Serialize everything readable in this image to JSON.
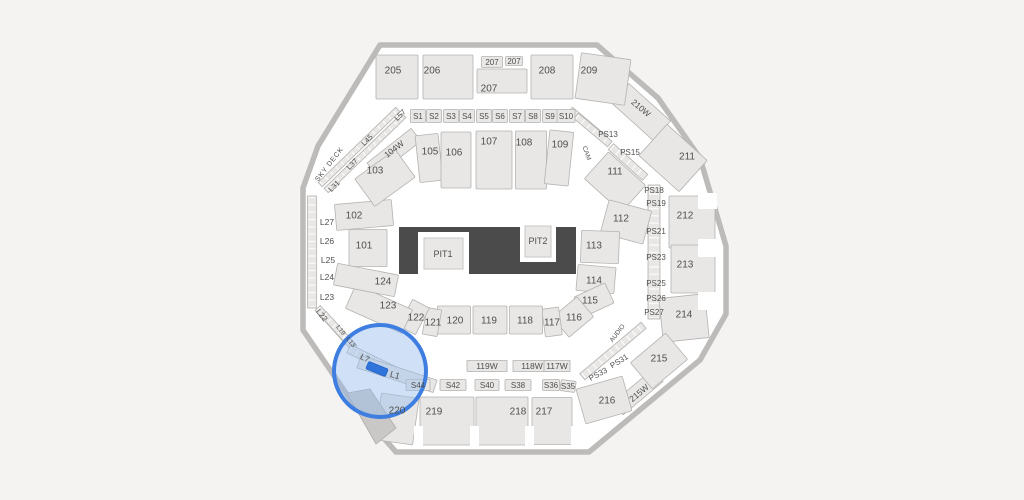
{
  "app": {
    "view": "arena-seating-map"
  },
  "colors": {
    "background": "#f4f3f1",
    "floor": "#ffffff",
    "wall": "#bdbbb9",
    "section_fill": "#e8e7e6",
    "section_stroke": "#b5b3b1",
    "label": "#4f4f4f",
    "label_light": "#9b9b9b",
    "stage_fill": "#4b4b4b",
    "highlight_fill": "rgba(151,188,238,0.45)",
    "highlight_ring": "#3e7ee0",
    "selected_fill": "#2e74da"
  },
  "stage": {
    "label": "STAGE",
    "pit1": "PIT1",
    "pit2": "PIT2"
  },
  "highlight": {
    "circle": {
      "cx": 380,
      "cy": 371,
      "r": 46
    },
    "selected": {
      "cx": 377,
      "cy": 369,
      "w": 21,
      "h": 8,
      "rot": 22
    }
  },
  "sections": [
    [
      "205",
      397,
      77,
      42,
      44,
      0,
      393,
      70
    ],
    [
      "206",
      448,
      77,
      50,
      44,
      0,
      432,
      70
    ],
    [
      "207",
      492,
      62,
      21,
      11,
      0,
      492,
      62,
      8
    ],
    [
      "207",
      514,
      61,
      17,
      9,
      0,
      514,
      61,
      8
    ],
    [
      "207",
      502,
      81,
      50,
      24,
      0,
      489,
      88
    ],
    [
      "208",
      552,
      77,
      42,
      44,
      0,
      547,
      70
    ],
    [
      "209",
      603,
      79,
      50,
      46,
      8,
      589,
      70
    ],
    [
      "211",
      673,
      158,
      54,
      42,
      42,
      687,
      156
    ],
    [
      "212",
      692,
      222,
      46,
      52,
      0,
      685,
      215
    ],
    [
      "213",
      693,
      269,
      44,
      48,
      0,
      685,
      264
    ],
    [
      "214",
      684,
      318,
      46,
      44,
      -6,
      684,
      314
    ],
    [
      "215",
      659,
      361,
      46,
      34,
      -40,
      659,
      358
    ],
    [
      "216",
      604,
      400,
      48,
      36,
      -16,
      607,
      400
    ],
    [
      "217",
      552,
      421,
      40,
      47,
      0,
      544,
      411
    ],
    [
      "218",
      502,
      421,
      52,
      48,
      0,
      518,
      411
    ],
    [
      "219",
      447,
      421,
      54,
      48,
      0,
      434,
      411
    ],
    [
      "220",
      397,
      419,
      38,
      47,
      8,
      397,
      410
    ],
    [
      "S44",
      418,
      385,
      24,
      11,
      0,
      418,
      385,
      8
    ],
    [
      "S42",
      453,
      385,
      26,
      11,
      0,
      453,
      385,
      8
    ],
    [
      "S40",
      487,
      385,
      24,
      11,
      0,
      487,
      385,
      8
    ],
    [
      "S38",
      518,
      385,
      26,
      11,
      0,
      518,
      385,
      8
    ],
    [
      "S36",
      551,
      385,
      17,
      11,
      0,
      551,
      385,
      8
    ],
    [
      "S35",
      568,
      386,
      15,
      11,
      8,
      568,
      386,
      8
    ],
    [
      "S1",
      418,
      116,
      15,
      13,
      0,
      418,
      116,
      8
    ],
    [
      "S2",
      434,
      116,
      15,
      13,
      0,
      434,
      116,
      8
    ],
    [
      "S3",
      451,
      116,
      15,
      13,
      0,
      451,
      116,
      8
    ],
    [
      "S4",
      467,
      116,
      15,
      13,
      0,
      467,
      116,
      8
    ],
    [
      "S5",
      484,
      116,
      15,
      13,
      0,
      484,
      116,
      8
    ],
    [
      "S6",
      500,
      116,
      15,
      13,
      0,
      500,
      116,
      8
    ],
    [
      "S7",
      517,
      116,
      15,
      13,
      0,
      517,
      116,
      8
    ],
    [
      "S8",
      533,
      116,
      15,
      13,
      0,
      533,
      116,
      8
    ],
    [
      "S9",
      550,
      116,
      15,
      13,
      0,
      550,
      116,
      8
    ],
    [
      "S10",
      566,
      116,
      18,
      13,
      0,
      566,
      116,
      8
    ],
    [
      "101",
      368,
      248,
      38,
      37,
      0,
      364,
      245
    ],
    [
      "102",
      364,
      215,
      57,
      26,
      -5,
      354,
      215
    ],
    [
      "103",
      385,
      178,
      50,
      34,
      -36,
      375,
      170
    ],
    [
      "105",
      429,
      158,
      23,
      47,
      -6,
      430,
      151
    ],
    [
      "106",
      456,
      160,
      30,
      56,
      0,
      454,
      152
    ],
    [
      "107",
      494,
      160,
      36,
      58,
      0,
      489,
      141
    ],
    [
      "108",
      531,
      160,
      31,
      58,
      0,
      524,
      142
    ],
    [
      "109",
      559,
      158,
      24,
      54,
      6,
      560,
      144
    ],
    [
      "111",
      615,
      182,
      50,
      36,
      42,
      615,
      171
    ],
    [
      "112",
      626,
      222,
      44,
      34,
      15,
      621,
      218
    ],
    [
      "113",
      600,
      247,
      38,
      32,
      2,
      594,
      245
    ],
    [
      "114",
      596,
      279,
      38,
      26,
      5,
      594,
      280
    ],
    [
      "115",
      594,
      300,
      34,
      22,
      -25,
      590,
      300
    ],
    [
      "116",
      573,
      317,
      32,
      26,
      -40,
      574,
      317
    ],
    [
      "117",
      552,
      322,
      17,
      28,
      -8,
      552,
      322
    ],
    [
      "118",
      526,
      320,
      33,
      28,
      0,
      525,
      320
    ],
    [
      "119",
      490,
      320,
      34,
      28,
      0,
      489,
      320
    ],
    [
      "120",
      454,
      320,
      33,
      28,
      0,
      455,
      320
    ],
    [
      "121",
      432,
      322,
      15,
      27,
      10,
      433,
      322
    ],
    [
      "122",
      414,
      317,
      19,
      30,
      28,
      416,
      317
    ],
    [
      "123",
      379,
      309,
      62,
      26,
      24,
      388,
      305
    ],
    [
      "124",
      366,
      280,
      62,
      22,
      11,
      383,
      281
    ]
  ],
  "strips": [
    [
      312,
      252,
      9,
      112,
      0,
      1
    ],
    [
      359,
      147,
      108,
      6,
      -44,
      1
    ],
    [
      365,
      153,
      108,
      6,
      -44,
      1
    ],
    [
      333,
      325,
      46,
      7,
      48,
      1
    ],
    [
      339,
      331,
      46,
      7,
      48,
      1
    ],
    [
      374,
      361,
      56,
      9,
      26,
      1
    ],
    [
      397,
      374,
      80,
      13,
      18,
      0
    ],
    [
      654,
      252,
      12,
      134,
      0,
      1
    ],
    [
      587,
      124,
      44,
      7,
      40,
      1
    ],
    [
      593,
      130,
      44,
      7,
      40,
      1
    ],
    [
      628,
      162,
      46,
      8,
      42,
      1
    ],
    [
      613,
      351,
      80,
      8,
      -40,
      1
    ],
    [
      641,
      112,
      56,
      26,
      42,
      0
    ],
    [
      638,
      392,
      52,
      16,
      -40,
      0
    ],
    [
      394,
      152,
      56,
      16,
      -38,
      0
    ],
    [
      487,
      366,
      40,
      11,
      0,
      0
    ],
    [
      531,
      366,
      36,
      11,
      0,
      0
    ],
    [
      557,
      366,
      26,
      11,
      0,
      0
    ]
  ],
  "floating_labels": [
    [
      "SKY DECK",
      329,
      164,
      -52,
      7,
      0
    ],
    [
      "L31",
      334,
      186,
      -45,
      7.5,
      0
    ],
    [
      "L37",
      352,
      164,
      -45,
      7.5,
      0
    ],
    [
      "L45",
      367,
      140,
      -45,
      7.5,
      0
    ],
    [
      "L57",
      400,
      115,
      -45,
      7.5,
      0
    ],
    [
      "L27",
      327,
      222,
      0,
      8.5,
      0
    ],
    [
      "L26",
      327,
      241,
      0,
      8.5,
      0
    ],
    [
      "L25",
      328,
      260,
      0,
      8.5,
      0
    ],
    [
      "L24",
      327,
      277,
      0,
      8.5,
      0
    ],
    [
      "L23",
      327,
      297,
      0,
      8.5,
      0
    ],
    [
      "L22",
      322,
      315,
      52,
      8,
      0
    ],
    [
      "L19",
      341,
      330,
      52,
      6.5,
      0
    ],
    [
      "L13",
      351,
      342,
      52,
      6.5,
      0
    ],
    [
      "L7",
      365,
      358,
      26,
      8.5,
      0
    ],
    [
      "L1",
      395,
      375,
      16,
      9,
      0
    ],
    [
      "210W",
      641,
      108,
      40,
      8.5,
      0
    ],
    [
      "215W",
      639,
      393,
      -40,
      8.5,
      0
    ],
    [
      "104W",
      394,
      149,
      -38,
      8.5,
      0
    ],
    [
      "119W",
      487,
      366,
      0,
      8.5,
      0
    ],
    [
      "118W",
      532,
      366,
      0,
      8.5,
      0
    ],
    [
      "117W",
      557,
      366,
      0,
      8.5,
      0
    ],
    [
      "CAM",
      587,
      153,
      70,
      6.5,
      0
    ],
    [
      "AUDIO",
      617,
      333,
      -52,
      6.5,
      0
    ],
    [
      "PS13",
      608,
      134,
      0,
      8,
      0
    ],
    [
      "PS15",
      630,
      152,
      0,
      8,
      0
    ],
    [
      "PS18",
      654,
      190,
      0,
      8,
      0
    ],
    [
      "PS19",
      656,
      203,
      0,
      8,
      0
    ],
    [
      "PS21",
      656,
      231,
      0,
      8,
      0
    ],
    [
      "PS23",
      656,
      257,
      0,
      8,
      0
    ],
    [
      "PS25",
      656,
      283,
      0,
      8,
      0
    ],
    [
      "PS26",
      656,
      298,
      0,
      8,
      0
    ],
    [
      "PS27",
      654,
      312,
      0,
      8,
      0
    ],
    [
      "PS31",
      619,
      361,
      -32,
      8,
      0
    ],
    [
      "PS33",
      598,
      374,
      -28,
      8,
      0
    ],
    [
      "PIT1",
      443,
      254,
      0,
      9,
      0
    ],
    [
      "PIT2",
      538,
      241,
      0,
      9,
      0
    ],
    [
      "STAGE",
      495,
      247,
      0,
      5,
      1
    ]
  ]
}
